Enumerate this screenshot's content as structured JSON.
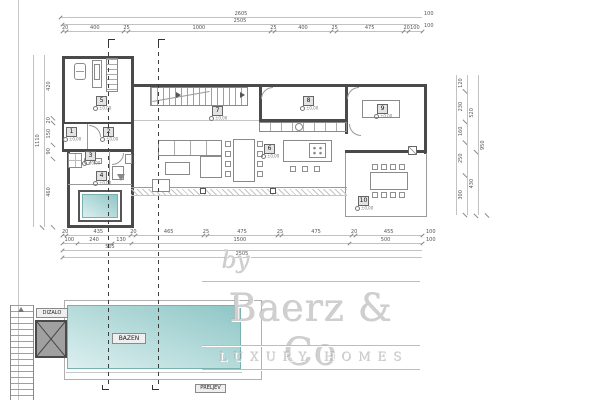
{
  "watermark": {
    "by": "by",
    "brand": "Baerz & Co",
    "tagline": "LUXURY HOMES"
  },
  "plan": {
    "room_numbers": [
      "1",
      "2",
      "3",
      "4",
      "5",
      "6",
      "7",
      "8",
      "9",
      "10"
    ],
    "elevation_marker": "±0,00",
    "labels": {
      "pool": "BAZEN",
      "elevator": "DIZALO",
      "overflow": "PRELJEV"
    }
  },
  "dimensions": {
    "top": {
      "overall": "2605",
      "inner": "2505",
      "segments": [
        "20",
        "400",
        "25",
        "1000",
        "25",
        "400",
        "25",
        "475",
        "20",
        "100"
      ],
      "right_edge": [
        "100",
        "100"
      ]
    },
    "bottom": {
      "row1": [
        "20",
        "435",
        "20",
        "465",
        "25",
        "475",
        "25",
        "475",
        "20",
        "455"
      ],
      "row2": [
        "100",
        "240",
        "130",
        "1500",
        "500"
      ],
      "row3_label": "505",
      "overall": "2505",
      "right_edge": [
        "100",
        "100"
      ]
    },
    "left": {
      "overall": "1110",
      "segments": [
        "420",
        "20",
        "150",
        "90",
        "460"
      ]
    },
    "right": {
      "overall": "950",
      "col1": [
        "120",
        "230",
        "160",
        "250",
        "300"
      ],
      "col2": [
        "520",
        "430"
      ]
    }
  },
  "colors": {
    "pool_light": "#dcefef",
    "pool_dark": "#8fc6c6",
    "wall": "#4a4a4a",
    "watermark": "#cfcfcf",
    "dim_line": "#c2c2c2"
  }
}
